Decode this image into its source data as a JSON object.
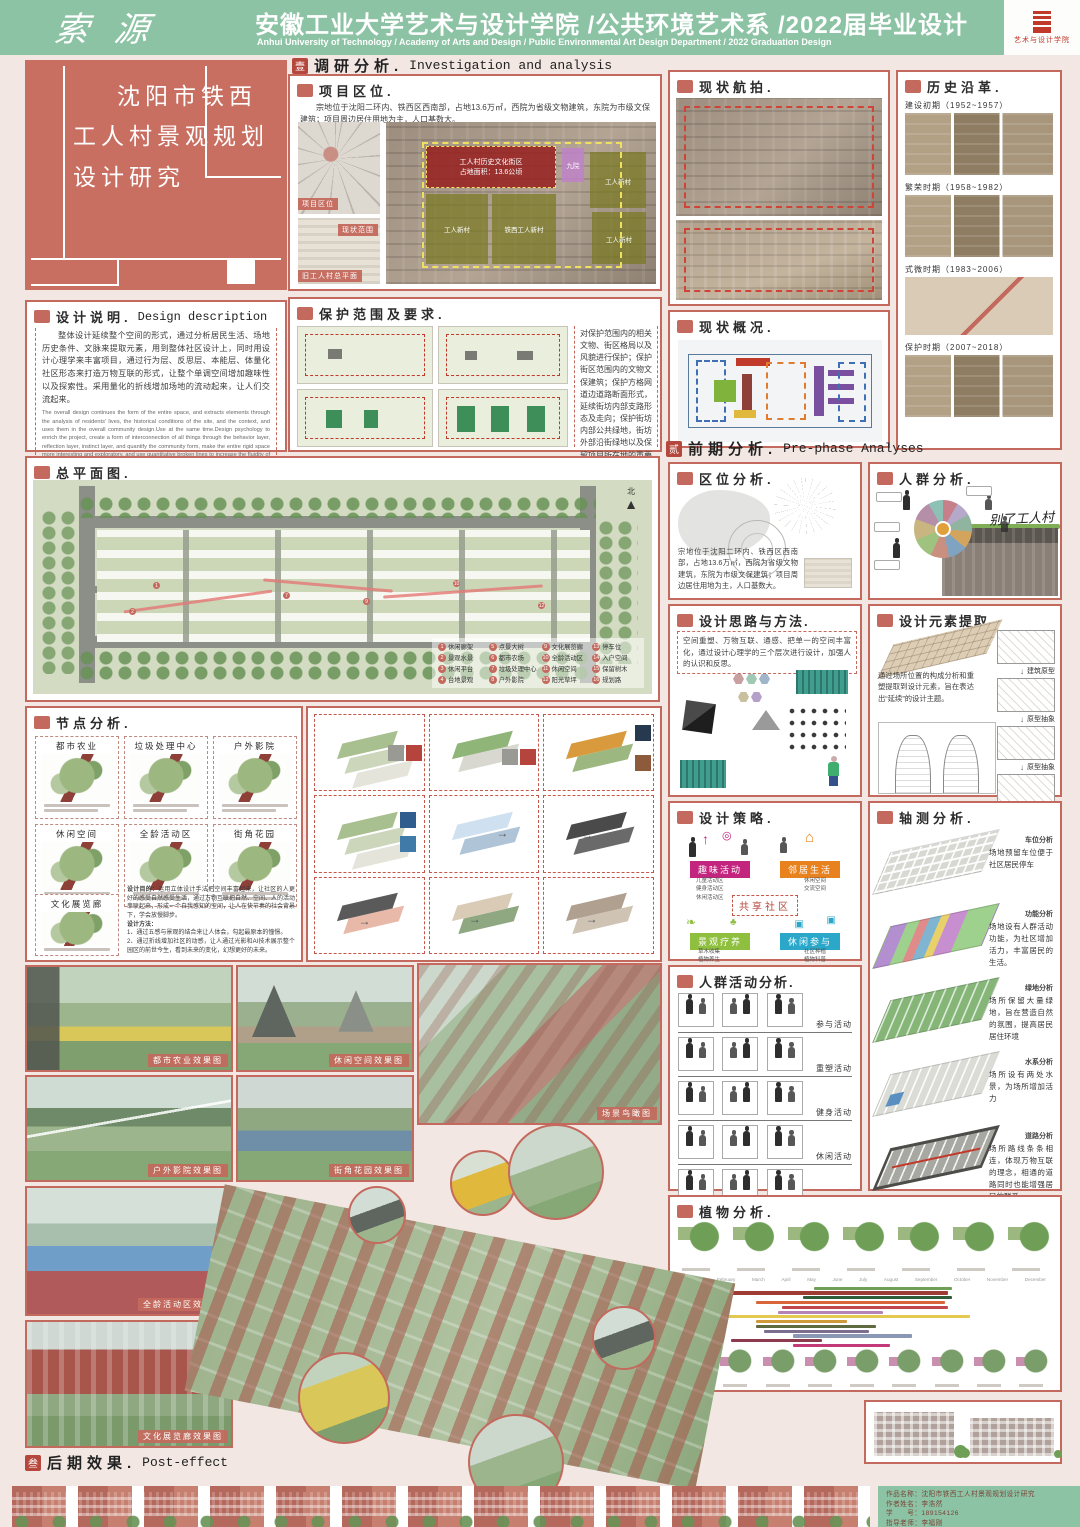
{
  "header": {
    "logo": "索源",
    "title": "安徽工业大学艺术与设计学院 /公共环境艺术系 /2022届毕业设计",
    "subtitle": "Anhui University of Technology / Academy of Arts and Design / Public Environmental Art Design Department / 2022 Graduation Design",
    "badge_label": "艺术与设计学院"
  },
  "title_block": {
    "l1": "沈阳市铁西",
    "l2": "工人村景观规划",
    "l3": "设计研究"
  },
  "sections": {
    "s1": {
      "num": "壹",
      "cn": "调研分析.",
      "en": "Investigation and analysis"
    },
    "s2": {
      "num": "贰",
      "cn": "前期分析.",
      "en": "Pre-phase Analyses"
    },
    "s3": {
      "num": "叁",
      "cn": "后期效果.",
      "en": "Post-effect"
    }
  },
  "location": {
    "title": "项目区位.",
    "text": "宗地位于沈阳二环内、铁西区西南部，占地13.6万㎡，西院为省级文物建筑，东院为市级文保建筑；项目周边居住用地为主，人口基数大。",
    "badge_map": "项目区位",
    "badge_note": "现状范围",
    "badge_plan": "旧工人村总平面",
    "parcel_red": "工人村历史文化街区",
    "parcel_red_sub": "占地面积：13.6公顷",
    "parcel_purple": "九院",
    "parcel_o1": "工人新村",
    "parcel_o2": "铁西工人新村",
    "parcel_o3": "工人新村",
    "parcel_o4": "工人新村"
  },
  "aerial": {
    "title": "现状航拍."
  },
  "history": {
    "title": "历史沿革.",
    "periods": [
      {
        "label": "建设初期（1952~1957）"
      },
      {
        "label": "繁荣时期（1958~1982）"
      },
      {
        "label": "式微时期（1983~2006）"
      },
      {
        "label": "保护时期（2007~2018）"
      }
    ]
  },
  "design_desc": {
    "title": "设计说明.",
    "title_en": "Design description",
    "cn": "整体设计延续整个空间的形式，通过分析居民生活、场地历史条件、文脉来提取元素，用到整体社区设计上，同时用设计心理学来丰富项目，通过行为层、反思层、本能层、体量化社区形态来打造万物互联的形式，让整个单调空间增加趣味性以及探索性。采用量化的折线增加场地的流动起来，让人们交流起来。",
    "en": "The overall design continues the form of the entire space, and extracts elements through the analysis of residents' lives, the historical conditions of the site, and the context, and uses them in the overall community design.Use at the same time.Design psychology to enrich the project, create a form of interconnection of all things through the behavior layer, reflection layer, instinct layer, and quantify the community form, make the entire rigid space more interesting and exploratory, and use quantitative broken lines to increase the fluidity of the site , let the space flow and make people communicate."
  },
  "protection": {
    "title": "保护范围及要求.",
    "text": "对保护范围内的相关文物、街区格局以及风貌进行保护；保护街区范围内的文物文保建筑；保护方格网道边道路断面形式，延续街坊内部支路形态及走向；保护街坊内部公共绿地，街坊外部沿街绿地以及保留项目所在地的重要历史文化信息。"
  },
  "status": {
    "title": "现状概况."
  },
  "masterplan": {
    "title": "总平面图.",
    "north": "北",
    "legend": [
      {
        "n": "1",
        "label": "休闲廊架"
      },
      {
        "n": "5",
        "label": "点景大树"
      },
      {
        "n": "9",
        "label": "文化展览廊"
      },
      {
        "n": "13",
        "label": "停车位"
      },
      {
        "n": "2",
        "label": "景观水景"
      },
      {
        "n": "6",
        "label": "都市农场"
      },
      {
        "n": "10",
        "label": "全龄活动区"
      },
      {
        "n": "14",
        "label": "入户空间"
      },
      {
        "n": "3",
        "label": "休闲平台"
      },
      {
        "n": "7",
        "label": "垃圾处理中心"
      },
      {
        "n": "11",
        "label": "休闲空间"
      },
      {
        "n": "15",
        "label": "保留树木"
      },
      {
        "n": "4",
        "label": "台地景观"
      },
      {
        "n": "8",
        "label": "户外影院"
      },
      {
        "n": "12",
        "label": "阳光草坪"
      },
      {
        "n": "16",
        "label": "规划路"
      }
    ]
  },
  "loc_analysis": {
    "title": "区位分析.",
    "text": "宗地位于沈阳二环内、铁西区西南部，占地13.6万㎡，西院为省级文物建筑，东院为市级文保建筑；项目周边居住用地为主，人口基数大。"
  },
  "crowd": {
    "title": "人群分析.",
    "script": "别了工人村"
  },
  "method": {
    "title": "设计思路与方法.",
    "text": "空间重塑、万物互联、通感、把单一的空间丰富化，通过设计心理学的三个层次进行设计，加强人的认识和反思。"
  },
  "elements": {
    "title": "设计元素提取.",
    "text": "通过场所位置的构成分析和重塑提取到设计元素，旨在表达出“延续”的设计主题。",
    "steps": [
      "建筑原型",
      "原型抽象",
      "原型抽象",
      "原型抽象"
    ]
  },
  "nodes": {
    "title": "节点分析.",
    "cards": [
      "都市农业",
      "垃圾处理中心",
      "户外影院",
      "休闲空间",
      "全龄活动区",
      "街角花园"
    ],
    "card7": "文化展览廊",
    "purpose_h": "设计目的：",
    "purpose": "运用立体设计手法把空间丰富起来，让社区的人更好的感受自然感受生活，通过万物互联把自然、空间、人的活动串联起来，形成一个自我感知的空间，让人在快节奏的社会背景下，学会放慢脚步。",
    "method_h": "设计方法：",
    "m1": "1、通过五感与景观的结合来让人体会，勾起最原本的憧憬。",
    "m2": "2、通过折线增加社区的动感，让人通过光影和AI技术展示整个园区的前世今生，看到未来的变化，幻想更好的未来。"
  },
  "strategy": {
    "title": "设计策略.",
    "center": "共享社区",
    "q1": {
      "label": "趣味活动",
      "subs": "儿童活动区\n健身活动区\n休闲活动区"
    },
    "q2": {
      "label": "邻居生活",
      "subs": "休闲空间\n交流空间"
    },
    "q3": {
      "label": "景观疗养",
      "subs": "草木收集\n植物养生"
    },
    "q4": {
      "label": "休闲参与",
      "subs": "社区种植\n植物科普"
    }
  },
  "axon": {
    "title": "轴测分析.",
    "layers": [
      {
        "label": "车位分析",
        "text": "场地预留车位便于社区居民停车"
      },
      {
        "label": "功能分析",
        "text": "场地设有人群活动功能，为社区增加活力，丰富居民的生活。"
      },
      {
        "label": "绿地分析",
        "text": "场所保留大量绿地，旨在营造自然的氛围，提高居民居住环境"
      },
      {
        "label": "水系分析",
        "text": "场所设有两处水景，为场所增加活力"
      },
      {
        "label": "道路分析",
        "text": "场所路线条条相连，体现万物互联的理念，相通的道路同时也能增强居民的联系"
      }
    ]
  },
  "activities": {
    "title": "人群活动分析.",
    "rows": [
      "参与活动",
      "重塑活动",
      "健身活动",
      "休闲活动",
      "交流活动"
    ]
  },
  "plants": {
    "title": "植物分析.",
    "months": [
      "January",
      "February",
      "March",
      "April",
      "May",
      "June",
      "July",
      "August",
      "September",
      "October",
      "November",
      "December"
    ],
    "bars": [
      {
        "c": "#6f9e57",
        "s": 36,
        "w": 38
      },
      {
        "c": "#9e3b33",
        "s": 0,
        "w": 73
      },
      {
        "c": "#2f5d3a",
        "s": 33,
        "w": 41
      },
      {
        "c": "#d9653a",
        "s": 20,
        "w": 52
      },
      {
        "c": "#c0474b",
        "s": 27,
        "w": 46
      },
      {
        "c": "#b583b5",
        "s": 26,
        "w": 29
      },
      {
        "c": "#e3c94f",
        "s": 2,
        "w": 77
      },
      {
        "c": "#cf9b3a",
        "s": 20,
        "w": 25
      },
      {
        "c": "#5d6b3f",
        "s": 20,
        "w": 33
      },
      {
        "c": "#7b6e8e",
        "s": 22,
        "w": 29
      },
      {
        "c": "#8a97b5",
        "s": 30,
        "w": 33
      },
      {
        "c": "#8e3a4e",
        "s": 13,
        "w": 25
      },
      {
        "c": "#c23a78",
        "s": 30,
        "w": 27
      }
    ]
  },
  "renders": {
    "r1": "都市农业效果图",
    "r2": "户外影院效果图",
    "r3": "全龄活动区效果图",
    "r4": "文化展览廊效果图",
    "r5": "休闲空间效果图",
    "r6": "街角花园效果图",
    "r7": "场景鸟瞰图"
  },
  "footer": {
    "project": "作品名称：沈阳市铁西工人村景观规划设计研究",
    "author": "作者姓名：李浩然",
    "sid": "学　　号：189154126",
    "advisor": "指导老师：李福刚"
  }
}
